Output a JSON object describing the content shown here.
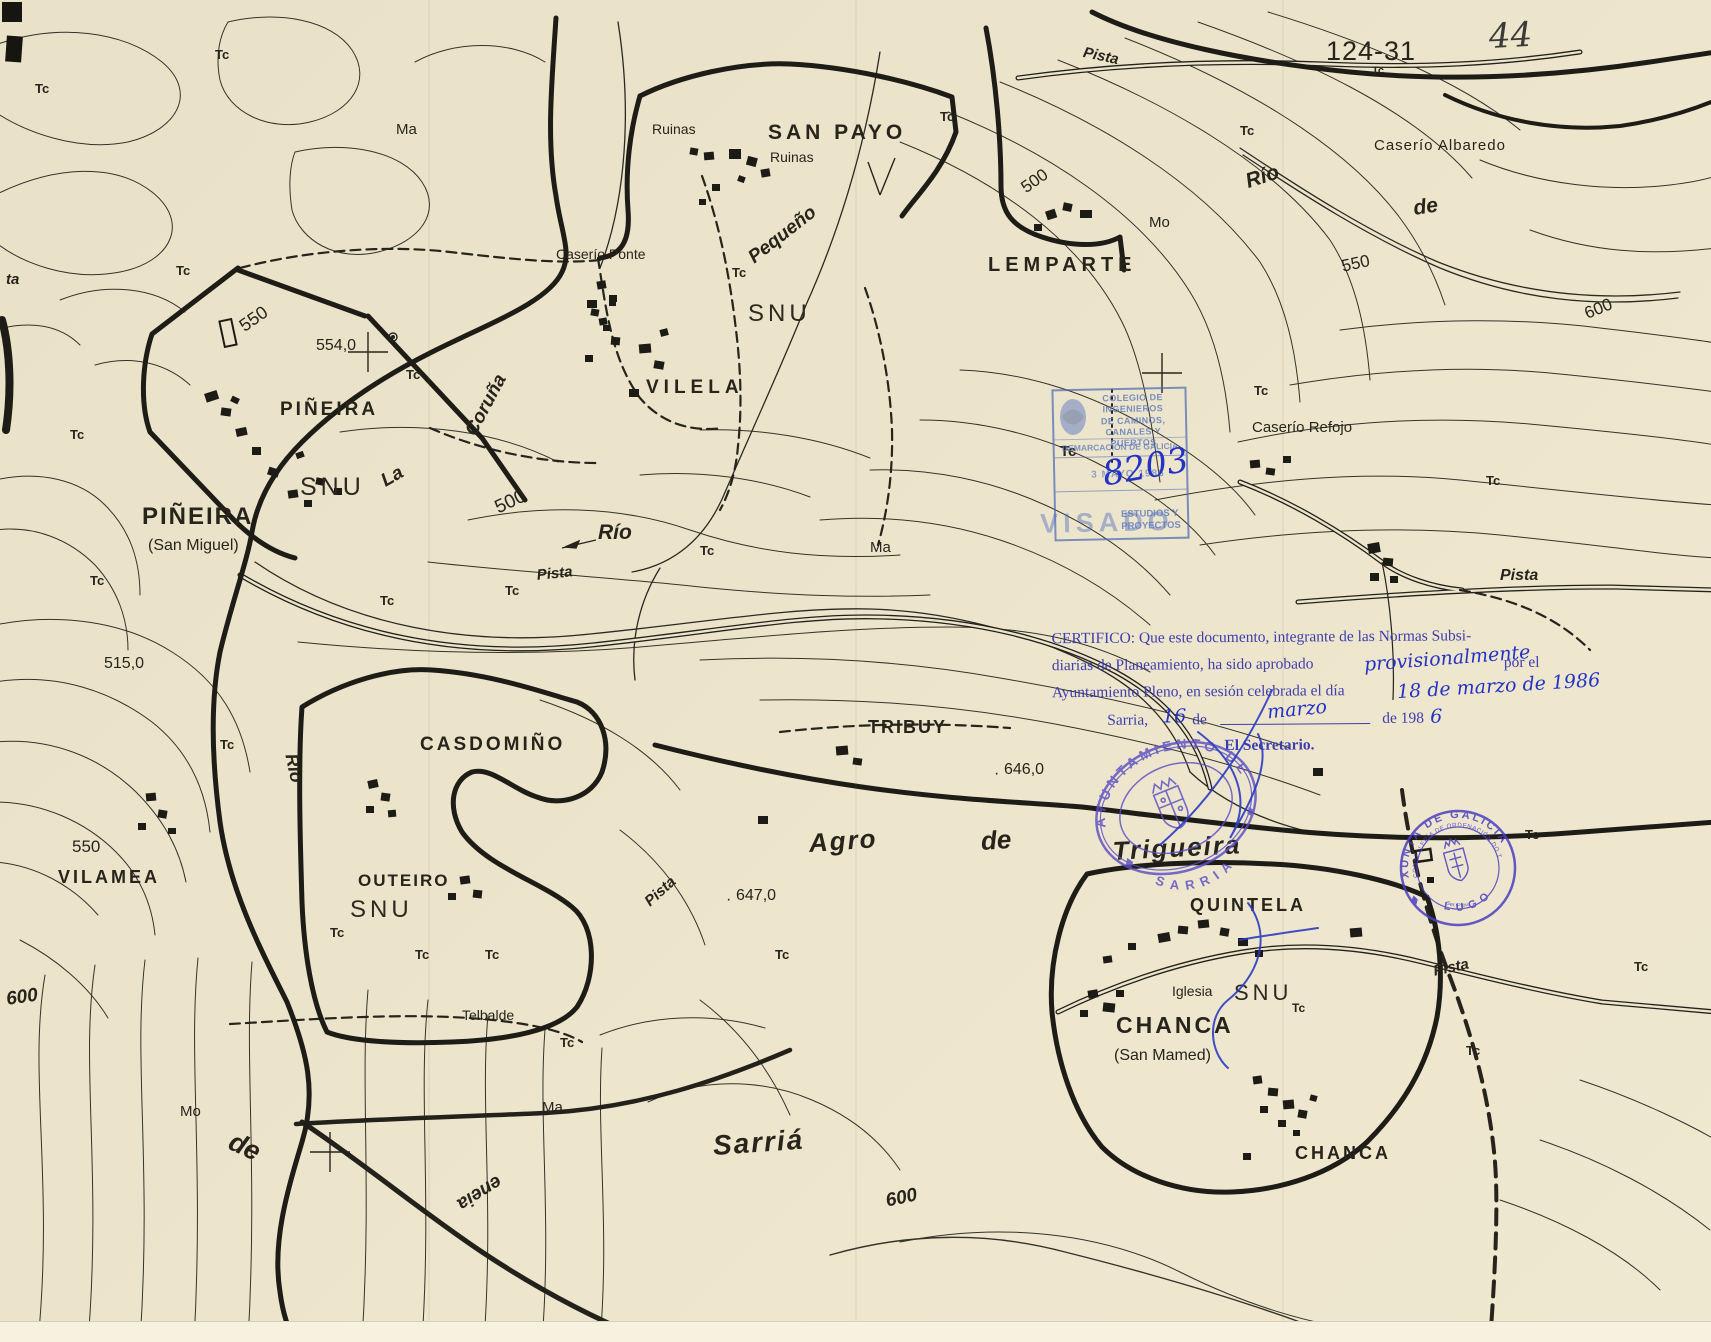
{
  "sheet": {
    "number": "124-31",
    "tc_small": "Tc",
    "page_number": "44"
  },
  "labels": {
    "tc": "Tc",
    "ma": "Ma",
    "mo": "Mo",
    "ta": "ta",
    "ruinas": "Ruinas",
    "san_payo": "SAN PAYO",
    "caserio_ponte": "Caserío Ponte",
    "vilela": "VILELA",
    "pequeno": "Pequeño",
    "snu": "SNU",
    "lemparte": "LEMPARTE",
    "caserio_albaredo": "Caserío Albaredo",
    "rio": "Río",
    "de": "de",
    "la": "La",
    "coruna": "Coruña",
    "pista": "Pista",
    "pineira": "PIÑEIRA",
    "san_miguel": "(San Miguel)",
    "caserio_refojo": "Caserío Refojo",
    "casdomino": "CASDOMIÑO",
    "tribuy": "TRIBUY",
    "agro": "Agro",
    "trigueira": "Trigueira",
    "outeiro": "OUTEIRO",
    "vilamea": "VILAMEA",
    "quintela": "QUINTELA",
    "iglesia": "Iglesia",
    "chanca": "CHANCA",
    "san_mamed": "(San Mamed)",
    "telbalde": "Telbalde",
    "sarria": "Sarriá",
    "road_rotated": "eneia"
  },
  "elevations": {
    "e500": "500",
    "e515": "515,0",
    "e550": "550",
    "e554": "554,0",
    "e600": "600",
    "e646": "646,0",
    "e647": "647,0"
  },
  "certification": {
    "line1": "CERTIFICO: Que este documento, integrante de las Normas Subsi-",
    "line2a": "diarias de Planeamiento, ha sido aprobado",
    "line2_hand": "provisionalmente",
    "line2b": "por el",
    "line3a": "Ayuntamiento Pleno, en sesión celebrada el día",
    "line3_hand": "18 de marzo de 1986",
    "line4a": "Sarria,",
    "line4_hand1": "16",
    "line4b": "de",
    "line4_hand2": "marzo",
    "line4c": "de 198",
    "line4_hand3": "6",
    "line5": "El Secretario."
  },
  "stamps": {
    "colegio": {
      "line1": "COLEGIO DE INGENIEROS",
      "line2": "DE CAMINOS, CANALES Y PUERTOS",
      "line3": "DEMARCACIÓN DE GALICIA",
      "date": "3 MAYO 1986",
      "visado": "VISADO",
      "dept": "ESTUDIOS Y PROYECTOS",
      "number": "8203"
    },
    "ayuntamiento": {
      "arc_top": "AYUNTAMIENTO DE",
      "arc_bottom": "SARRIA"
    },
    "xunta": {
      "arc_top": "XUNTA DE GALICIA",
      "arc_inner": "CONSELLERÍA DE ORDENACIÓN DO TERRITORIO",
      "arc_bottom": "LUGO",
      "small_text": "Ser. Prov."
    }
  },
  "colors": {
    "ink": "#27241b",
    "stamp_blue": "#4a5fb0",
    "stamp_violet": "#5b4ec5",
    "handwriting": "#2433c6"
  }
}
